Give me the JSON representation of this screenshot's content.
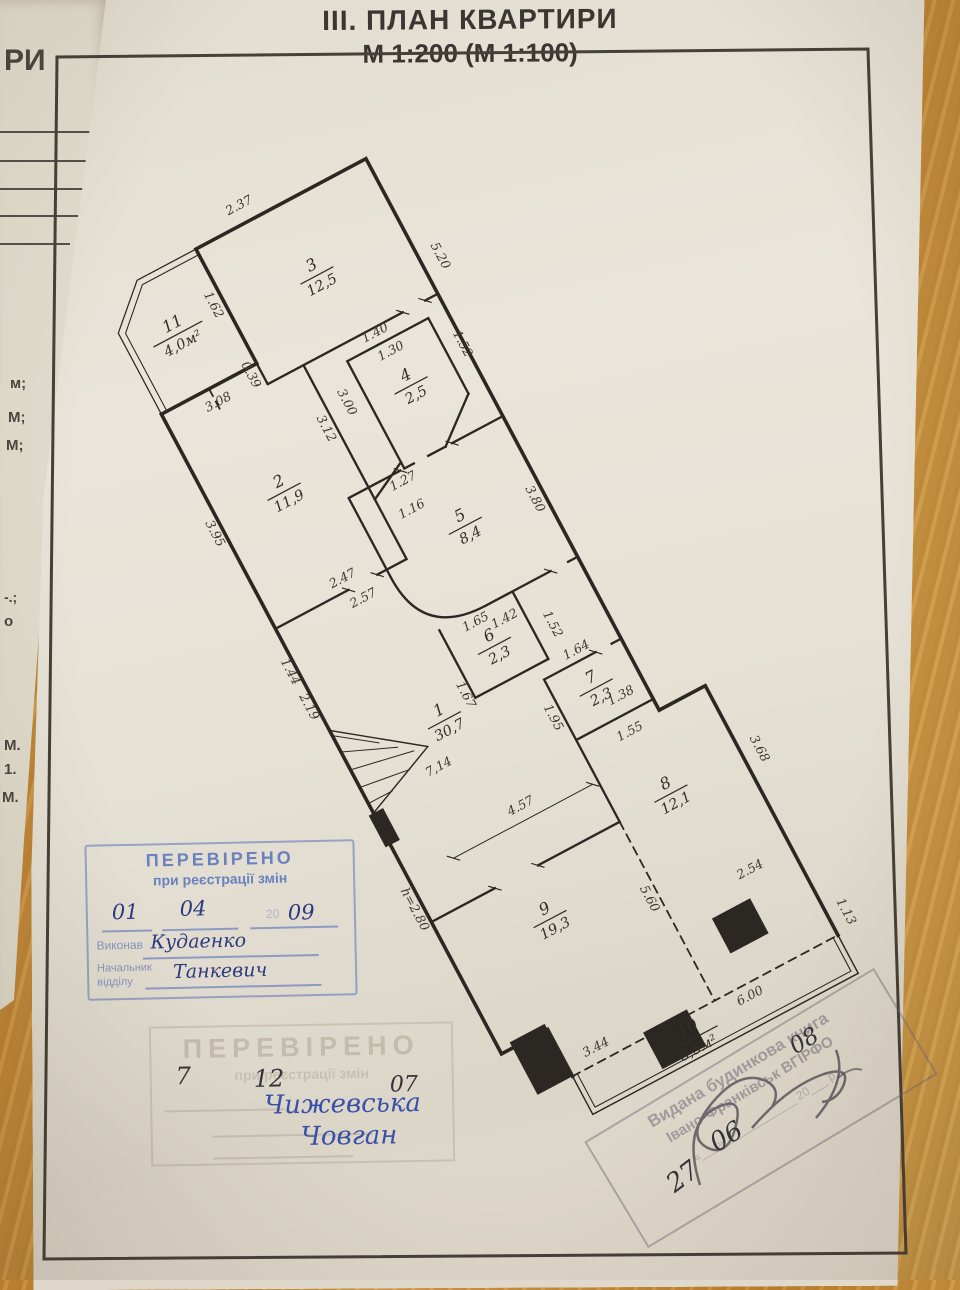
{
  "title": {
    "line1": "ІІІ. ПЛАН КВАРТИРИ",
    "line2": "М 1:200 (М 1:100)"
  },
  "left_page": {
    "fragments": [
      {
        "t": "РИ",
        "x": 4,
        "y": 46,
        "s": 30
      },
      {
        "t": "м;",
        "x": 10,
        "y": 376,
        "s": 15
      },
      {
        "t": "М;",
        "x": 8,
        "y": 410,
        "s": 15
      },
      {
        "t": "М;",
        "x": 6,
        "y": 438,
        "s": 15
      },
      {
        "t": "-.;",
        "x": 4,
        "y": 590,
        "s": 14
      },
      {
        "t": "о",
        "x": 4,
        "y": 614,
        "s": 15
      },
      {
        "t": "М.",
        "x": 4,
        "y": 738,
        "s": 15
      },
      {
        "t": "1.",
        "x": 4,
        "y": 762,
        "s": 15
      },
      {
        "t": "М.",
        "x": 2,
        "y": 790,
        "s": 15
      }
    ]
  },
  "plan": {
    "rooms": [
      {
        "n": "11",
        "a": "4,0м²",
        "x": 58,
        "y": 80
      },
      {
        "n": "3",
        "a": "12,5",
        "x": 225,
        "y": 95
      },
      {
        "n": "2",
        "a": "11,9",
        "x": 80,
        "y": 290
      },
      {
        "n": "4",
        "a": "2,5",
        "x": 260,
        "y": 252
      },
      {
        "n": "5",
        "a": "8,4",
        "x": 240,
        "y": 418
      },
      {
        "n": "6",
        "a": "2,3",
        "x": 206,
        "y": 551
      },
      {
        "n": "1",
        "a": "30,7",
        "x": 118,
        "y": 598
      },
      {
        "n": "7",
        "a": "2,3",
        "x": 284,
        "y": 645
      },
      {
        "n": "8",
        "a": "12,1",
        "x": 302,
        "y": 788
      },
      {
        "n": "9",
        "a": "19,3",
        "x": 118,
        "y": 848
      },
      {
        "n": "10",
        "a": "8,5м²",
        "x": 196,
        "y": 1040
      }
    ],
    "dims": [
      {
        "t": "2.37",
        "x": 185,
        "y": -10,
        "r": 0
      },
      {
        "t": "1.62",
        "x": 104,
        "y": 70,
        "r": 90
      },
      {
        "t": "0.39",
        "x": 104,
        "y": 158,
        "r": 90
      },
      {
        "t": "5.20",
        "x": 352,
        "y": 140,
        "r": 90
      },
      {
        "t": "3.08",
        "x": 62,
        "y": 172,
        "r": 0
      },
      {
        "t": "3.00",
        "x": 184,
        "y": 235,
        "r": 90
      },
      {
        "t": "3.12",
        "x": 150,
        "y": 250,
        "r": 90
      },
      {
        "t": "3.95",
        "x": -14,
        "y": 295,
        "r": 90
      },
      {
        "t": "1.27",
        "x": 202,
        "y": 346,
        "r": 0
      },
      {
        "t": "1.16",
        "x": 196,
        "y": 378,
        "r": 0
      },
      {
        "t": "1.40",
        "x": 252,
        "y": 186,
        "r": 0
      },
      {
        "t": "1.30",
        "x": 258,
        "y": 212,
        "r": 0
      },
      {
        "t": "1.52",
        "x": 328,
        "y": 238,
        "r": 90
      },
      {
        "t": "2.47",
        "x": 92,
        "y": 410,
        "r": 0
      },
      {
        "t": "2.57",
        "x": 102,
        "y": 440,
        "r": 0
      },
      {
        "t": "1.44",
        "x": -12,
        "y": 470,
        "r": 90
      },
      {
        "t": "2.19",
        "x": -12,
        "y": 514,
        "r": 90
      },
      {
        "t": "3.80",
        "x": 318,
        "y": 428,
        "r": 90
      },
      {
        "t": "1.65",
        "x": 200,
        "y": 522,
        "r": 0
      },
      {
        "t": "1.42",
        "x": 230,
        "y": 534,
        "r": 0
      },
      {
        "t": "1.52",
        "x": 270,
        "y": 560,
        "r": 90
      },
      {
        "t": "1.67",
        "x": 148,
        "y": 584,
        "r": 90
      },
      {
        "t": "7,14",
        "x": 88,
        "y": 645,
        "r": 0
      },
      {
        "t": "4.57",
        "x": 148,
        "y": 726,
        "r": 0
      },
      {
        "t": "1.64",
        "x": 284,
        "y": 602,
        "r": 0
      },
      {
        "t": "1.38",
        "x": 304,
        "y": 670,
        "r": 0
      },
      {
        "t": "1.55",
        "x": 294,
        "y": 710,
        "r": 0
      },
      {
        "t": "1.95",
        "x": 222,
        "y": 652,
        "r": 90
      },
      {
        "t": "h=2.80",
        "x": -14,
        "y": 768,
        "r": 90
      },
      {
        "t": "3.68",
        "x": 408,
        "y": 790,
        "r": 90
      },
      {
        "t": "2.54",
        "x": 340,
        "y": 908,
        "r": 0
      },
      {
        "t": "5.60",
        "x": 222,
        "y": 880,
        "r": 90
      },
      {
        "t": "3.44",
        "x": 96,
        "y": 1002,
        "r": 0
      },
      {
        "t": "6.00",
        "x": 274,
        "y": 1032,
        "r": 0
      },
      {
        "t": "1.13",
        "x": 408,
        "y": 995,
        "r": 90
      }
    ]
  },
  "stamps": {
    "verified": {
      "title": "ПЕРЕВІРЕНО",
      "subtitle": "при реєстрації змін",
      "day": "01",
      "month": "04",
      "year_prefix": "20",
      "year": "09",
      "executor_label": "Виконав",
      "chief_label1": "Начальник",
      "chief_label2": "відділу",
      "executor": "Кудаенко",
      "chief": "Танкевич"
    },
    "verified_faded": {
      "title": "ПЕРЕВІРЕНО",
      "subtitle": "при реєстрації змін",
      "day": "7",
      "month": "12",
      "year": "07",
      "name1": "Чижевська",
      "name2": "Човган"
    },
    "book": {
      "line1": "Видана будинкова книга",
      "line2": "Івано-Франківськ ВГІРФО",
      "line3": "«___» ____________ 20___ р.",
      "day": "27",
      "month": "06",
      "year": "08"
    }
  }
}
